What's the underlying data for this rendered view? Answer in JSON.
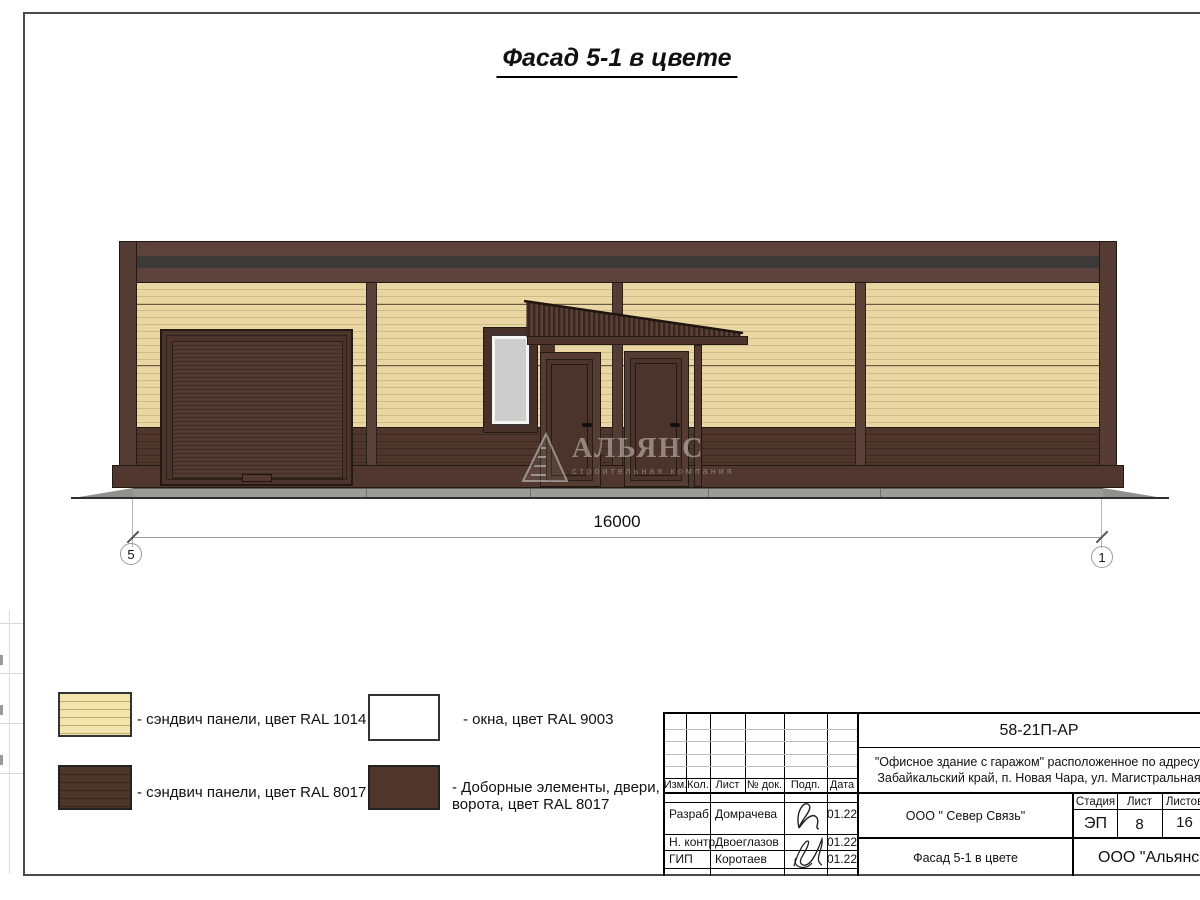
{
  "page": {
    "title": "Фасад 5-1 в цвете"
  },
  "drawing": {
    "dimension": "16000",
    "axis_left": "5",
    "axis_right": "1",
    "watermark": {
      "name": "АЛЬЯНС",
      "tagline": "строительная компания"
    }
  },
  "legend": {
    "items": [
      {
        "label": "- сэндвич панели, цвет RAL 1014",
        "swatch": "#e9d6a2",
        "pattern": "lines"
      },
      {
        "label": "- сэндвич панели, цвет RAL 8017",
        "swatch": "#4e362d",
        "pattern": "lines"
      },
      {
        "label": "- окна, цвет RAL 9003",
        "swatch": "#ffffff",
        "pattern": "plain"
      },
      {
        "label": "- Доборные элементы, двери, ворота, цвет RAL 8017",
        "swatch": "#4e362d",
        "pattern": "plain"
      }
    ]
  },
  "stamp": {
    "doc_number": "58-21П-АР",
    "address_line1": "\"Офисное здание с гаражом\" расположенное по адресу:",
    "address_line2": "Забайкальский край, п. Новая Чара, ул. Магистральная",
    "columns": [
      "Изм.",
      "Кол.",
      "Лист",
      "№ док.",
      "Подп.",
      "Дата"
    ],
    "rows": [
      {
        "role": "Разраб.",
        "name": "Домрачева",
        "date": "01.22"
      },
      {
        "role": "Н. контр.",
        "name": "Двоеглазов",
        "date": "01.22"
      },
      {
        "role": "ГИП",
        "name": "Коротаев",
        "date": "01.22"
      }
    ],
    "org": "ООО \" Север Связь\"",
    "sheet_title": "Фасад 5-1 в цвете",
    "stage_label": "Стадия",
    "stage": "ЭП",
    "sheet_label": "Лист",
    "sheet": "8",
    "sheets_label": "Листов",
    "sheets": "16",
    "company": "ООО \"Альянс\""
  },
  "colors": {
    "ral1014_panel": "#e9d6a2",
    "ral8017_panel": "#4e362d",
    "ral9003_window": "#ffffff",
    "parapet": "#5d423b",
    "dark_stripe": "#3b3a38",
    "apron_gray": "#9b9b98"
  }
}
